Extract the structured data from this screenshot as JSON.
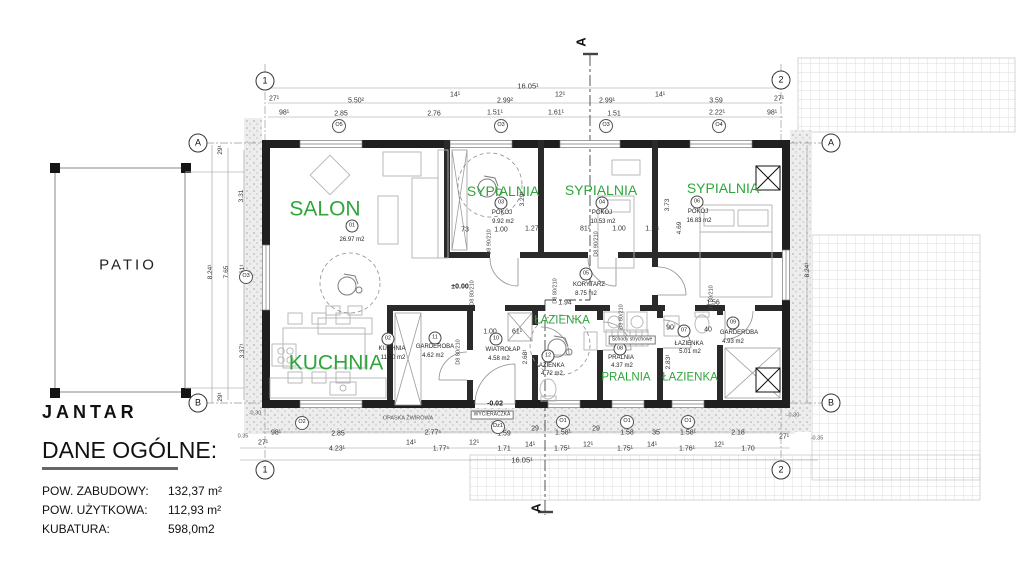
{
  "colors": {
    "room_label_green": "#2fa63b",
    "wall_color": "#1f1f1f",
    "annotation_color": "#333333"
  },
  "title_block": {
    "project_name": "JANTAR",
    "heading": "DANE OGÓLNE:",
    "stats": [
      {
        "label": "POW. ZABUDOWY:",
        "value": "132,37 m²"
      },
      {
        "label": "POW. UŻYTKOWA:",
        "value": "112,93 m²"
      },
      {
        "label": "KUBATURA:",
        "value": "598,0m2"
      }
    ]
  },
  "rooms": [
    {
      "number": "01",
      "name": "SALON",
      "area": "26.97 m2"
    },
    {
      "number": "02",
      "name": "KUCHNIA",
      "area": "11.60 m2"
    },
    {
      "number": "03",
      "name": "POKÓJ",
      "area": "9.92 m2"
    },
    {
      "number": "04",
      "name": "POKÓJ",
      "area": "10.53 m2"
    },
    {
      "number": "05",
      "name": "KORYTARZ",
      "area": "8.75 m2"
    },
    {
      "number": "06",
      "name": "POKÓJ",
      "area": "16.83 m2"
    },
    {
      "number": "07",
      "name": "ŁAZIENKA",
      "area": "5.01 m2"
    },
    {
      "number": "08",
      "name": "PRALNIA",
      "area": "4.37 m2"
    },
    {
      "number": "09",
      "name": "GARDEROBA",
      "area": "4.93 m2"
    },
    {
      "number": "10",
      "name": "WIATROŁAP",
      "area": "4.58 m2"
    },
    {
      "number": "11",
      "name": "GARDEROBA",
      "area": "4.62 m2"
    },
    {
      "number": "12",
      "name": "ŁAZIENKA",
      "area": "4.72 m2"
    }
  ],
  "annotations": [
    {
      "t": "SALON",
      "x": 325,
      "y": 209,
      "c": "green-lg"
    },
    {
      "t": "KUCHNIA",
      "x": 336,
      "y": 363,
      "c": "green-lg"
    },
    {
      "t": "SYPIALNIA",
      "x": 503,
      "y": 191,
      "c": "green-md"
    },
    {
      "t": "SYPIALNIA",
      "x": 601,
      "y": 190,
      "c": "green-md"
    },
    {
      "t": "SYPIALNIA",
      "x": 723,
      "y": 188,
      "c": "green-md"
    },
    {
      "t": "ŁAZIENKA",
      "x": 562,
      "y": 321,
      "c": "green-sm"
    },
    {
      "t": "PRALNIA",
      "x": 626,
      "y": 378,
      "c": "green-sm"
    },
    {
      "t": "ŁAZIENKA",
      "x": 690,
      "y": 378,
      "c": "green-sm"
    },
    {
      "t": "PATIO",
      "x": 128,
      "y": 265,
      "c": "patio"
    },
    {
      "t": "01",
      "x": 352,
      "y": 226,
      "c": "rnum"
    },
    {
      "t": "26.97 m2",
      "x": 352,
      "y": 240,
      "c": "rarea"
    },
    {
      "t": "02",
      "x": 388,
      "y": 339,
      "c": "rnum"
    },
    {
      "t": "KUCHNIA",
      "x": 392,
      "y": 349,
      "c": "rname"
    },
    {
      "t": "11.60 m2",
      "x": 393,
      "y": 358,
      "c": "rarea"
    },
    {
      "t": "03",
      "x": 501,
      "y": 203,
      "c": "rnum"
    },
    {
      "t": "POKÓJ",
      "x": 502,
      "y": 213,
      "c": "rname"
    },
    {
      "t": "9.92 m2",
      "x": 503,
      "y": 222,
      "c": "rarea"
    },
    {
      "t": "04",
      "x": 602,
      "y": 203,
      "c": "rnum"
    },
    {
      "t": "POKÓJ",
      "x": 602,
      "y": 213,
      "c": "rname"
    },
    {
      "t": "10.53 m2",
      "x": 603,
      "y": 222,
      "c": "rarea"
    },
    {
      "t": "06",
      "x": 697,
      "y": 202,
      "c": "rnum"
    },
    {
      "t": "POKÓJ",
      "x": 698,
      "y": 212,
      "c": "rname"
    },
    {
      "t": "16.83 m2",
      "x": 699,
      "y": 221,
      "c": "rarea"
    },
    {
      "t": "05",
      "x": 586,
      "y": 274,
      "c": "rnum"
    },
    {
      "t": "KORYTARZ",
      "x": 589,
      "y": 285,
      "c": "rname"
    },
    {
      "t": "8.75 m2",
      "x": 586,
      "y": 294,
      "c": "rarea"
    },
    {
      "t": "12",
      "x": 548,
      "y": 356,
      "c": "rnum"
    },
    {
      "t": "ŁAZIENKA",
      "x": 550,
      "y": 366,
      "c": "rname"
    },
    {
      "t": "4.72 m2",
      "x": 552,
      "y": 374,
      "c": "rarea"
    },
    {
      "t": "08",
      "x": 620,
      "y": 349,
      "c": "rnum"
    },
    {
      "t": "PRALNIA",
      "x": 621,
      "y": 358,
      "c": "rname"
    },
    {
      "t": "4.37 m2",
      "x": 622,
      "y": 366,
      "c": "rarea"
    },
    {
      "t": "07",
      "x": 684,
      "y": 331,
      "c": "rnum"
    },
    {
      "t": "ŁAZIENKA",
      "x": 689,
      "y": 344,
      "c": "rname"
    },
    {
      "t": "5.01 m2",
      "x": 690,
      "y": 352,
      "c": "rarea"
    },
    {
      "t": "09",
      "x": 733,
      "y": 323,
      "c": "rnum"
    },
    {
      "t": "GARDEROBA",
      "x": 739,
      "y": 333,
      "c": "rname"
    },
    {
      "t": "4.93 m2",
      "x": 733,
      "y": 342,
      "c": "rarea"
    },
    {
      "t": "10",
      "x": 496,
      "y": 339,
      "c": "rnum"
    },
    {
      "t": "WIATROŁAP",
      "x": 503,
      "y": 350,
      "c": "rname"
    },
    {
      "t": "4.58 m2",
      "x": 499,
      "y": 359,
      "c": "rarea"
    },
    {
      "t": "11",
      "x": 435,
      "y": 338,
      "c": "rnum"
    },
    {
      "t": "GARDEROBA",
      "x": 435,
      "y": 347,
      "c": "rname"
    },
    {
      "t": "4.62 m2",
      "x": 433,
      "y": 356,
      "c": "rarea"
    },
    {
      "t": "Schody strychowe",
      "x": 632,
      "y": 340,
      "c": "tinybox"
    },
    {
      "t": "WYCIERACZKA",
      "x": 492,
      "y": 415,
      "c": "tinybox"
    },
    {
      "t": "OPASKA ŻWIROWA",
      "x": 408,
      "y": 419,
      "c": "tiny"
    },
    {
      "t": "16.05¹",
      "x": 528,
      "y": 86,
      "c": "dimb"
    },
    {
      "t": "27¹",
      "x": 274,
      "y": 99,
      "c": "dim"
    },
    {
      "t": "5.50²",
      "x": 356,
      "y": 101,
      "c": "dim"
    },
    {
      "t": "14¹",
      "x": 455,
      "y": 95,
      "c": "dim"
    },
    {
      "t": "2.99²",
      "x": 505,
      "y": 101,
      "c": "dim"
    },
    {
      "t": "12¹",
      "x": 560,
      "y": 95,
      "c": "dim"
    },
    {
      "t": "2.99¹",
      "x": 607,
      "y": 101,
      "c": "dim"
    },
    {
      "t": "14¹",
      "x": 660,
      "y": 95,
      "c": "dim"
    },
    {
      "t": "3.59",
      "x": 716,
      "y": 101,
      "c": "dim"
    },
    {
      "t": "27¹",
      "x": 779,
      "y": 99,
      "c": "dim"
    },
    {
      "t": "98¹",
      "x": 284,
      "y": 113,
      "c": "dim"
    },
    {
      "t": "2.85",
      "x": 341,
      "y": 114,
      "c": "dim"
    },
    {
      "t": "2.76",
      "x": 434,
      "y": 114,
      "c": "dim"
    },
    {
      "t": "1.51¹",
      "x": 495,
      "y": 113,
      "c": "dim"
    },
    {
      "t": "1.61¹",
      "x": 556,
      "y": 113,
      "c": "dim"
    },
    {
      "t": "1.51",
      "x": 614,
      "y": 114,
      "c": "dim"
    },
    {
      "t": "2.22¹",
      "x": 717,
      "y": 113,
      "c": "dim"
    },
    {
      "t": "98¹",
      "x": 772,
      "y": 113,
      "c": "dim"
    },
    {
      "t": "O5",
      "x": 339,
      "y": 126,
      "c": "wtag"
    },
    {
      "t": "O3",
      "x": 501,
      "y": 126,
      "c": "wtag"
    },
    {
      "t": "O3",
      "x": 606,
      "y": 126,
      "c": "wtag"
    },
    {
      "t": "O4",
      "x": 719,
      "y": 126,
      "c": "wtag"
    },
    {
      "t": "-0.30",
      "x": 255,
      "y": 414,
      "c": "tiny"
    },
    {
      "t": "98¹",
      "x": 276,
      "y": 433,
      "c": "dim"
    },
    {
      "t": "2.85",
      "x": 338,
      "y": 434,
      "c": "dim"
    },
    {
      "t": "2.77⁵",
      "x": 433,
      "y": 433,
      "c": "dim"
    },
    {
      "t": "1.59",
      "x": 504,
      "y": 434,
      "c": "dim"
    },
    {
      "t": "29",
      "x": 535,
      "y": 429,
      "c": "dim"
    },
    {
      "t": "1.58¹",
      "x": 563,
      "y": 433,
      "c": "dim"
    },
    {
      "t": "29",
      "x": 596,
      "y": 429,
      "c": "dim"
    },
    {
      "t": "1.58",
      "x": 627,
      "y": 433,
      "c": "dim"
    },
    {
      "t": "35",
      "x": 656,
      "y": 433,
      "c": "dim"
    },
    {
      "t": "1.58¹",
      "x": 688,
      "y": 433,
      "c": "dim"
    },
    {
      "t": "2.18",
      "x": 738,
      "y": 433,
      "c": "dim"
    },
    {
      "t": "27¹",
      "x": 784,
      "y": 437,
      "c": "dim"
    },
    {
      "t": "-0.30",
      "x": 793,
      "y": 416,
      "c": "tiny"
    },
    {
      "t": "-0.35",
      "x": 817,
      "y": 439,
      "c": "tiny"
    },
    {
      "t": "0.35",
      "x": 243,
      "y": 437,
      "c": "tiny"
    },
    {
      "t": "27¹",
      "x": 263,
      "y": 443,
      "c": "dim"
    },
    {
      "t": "4.23¹",
      "x": 337,
      "y": 449,
      "c": "dim"
    },
    {
      "t": "14¹",
      "x": 411,
      "y": 443,
      "c": "dim"
    },
    {
      "t": "1.77⁵",
      "x": 441,
      "y": 449,
      "c": "dim"
    },
    {
      "t": "12¹",
      "x": 474,
      "y": 443,
      "c": "dim"
    },
    {
      "t": "1.71",
      "x": 504,
      "y": 449,
      "c": "dim"
    },
    {
      "t": "14¹",
      "x": 530,
      "y": 445,
      "c": "dim"
    },
    {
      "t": "1.75¹",
      "x": 562,
      "y": 449,
      "c": "dim"
    },
    {
      "t": "12¹",
      "x": 588,
      "y": 445,
      "c": "dim"
    },
    {
      "t": "1.75¹",
      "x": 625,
      "y": 449,
      "c": "dim"
    },
    {
      "t": "14¹",
      "x": 652,
      "y": 445,
      "c": "dim"
    },
    {
      "t": "1.76¹",
      "x": 687,
      "y": 449,
      "c": "dim"
    },
    {
      "t": "12¹",
      "x": 719,
      "y": 445,
      "c": "dim"
    },
    {
      "t": "1.70",
      "x": 748,
      "y": 449,
      "c": "dim"
    },
    {
      "t": "16.05¹",
      "x": 522,
      "y": 460,
      "c": "dimb"
    },
    {
      "t": "O2",
      "x": 302,
      "y": 423,
      "c": "wtag"
    },
    {
      "t": "Dz1",
      "x": 498,
      "y": 427,
      "c": "wtag"
    },
    {
      "t": "O1",
      "x": 563,
      "y": 422,
      "c": "wtag"
    },
    {
      "t": "O1",
      "x": 627,
      "y": 422,
      "c": "wtag"
    },
    {
      "t": "O1",
      "x": 688,
      "y": 422,
      "c": "wtag"
    },
    {
      "t": "3.31",
      "x": 242,
      "y": 196,
      "c": "vdim",
      "r": -90
    },
    {
      "t": "1.61¹",
      "x": 243,
      "y": 272,
      "c": "vdim",
      "r": -90
    },
    {
      "t": "3.37¹",
      "x": 243,
      "y": 351,
      "c": "vdim",
      "r": -90
    },
    {
      "t": "29¹",
      "x": 221,
      "y": 150,
      "c": "vdim",
      "r": -90
    },
    {
      "t": "29¹",
      "x": 221,
      "y": 397,
      "c": "vdim",
      "r": -90
    },
    {
      "t": "7.65",
      "x": 227,
      "y": 272,
      "c": "vdim",
      "r": -90
    },
    {
      "t": "8.24¹",
      "x": 211,
      "y": 272,
      "c": "vdim",
      "r": -90
    },
    {
      "t": "O3",
      "x": 246,
      "y": 277,
      "c": "wtag"
    },
    {
      "t": "8.24¹",
      "x": 808,
      "y": 270,
      "c": "vdim",
      "r": -90
    },
    {
      "t": "1",
      "x": 265,
      "y": 81,
      "c": "axis"
    },
    {
      "t": "2",
      "x": 781,
      "y": 80,
      "c": "axis"
    },
    {
      "t": "1",
      "x": 265,
      "y": 470,
      "c": "axis"
    },
    {
      "t": "2",
      "x": 781,
      "y": 470,
      "c": "axis"
    },
    {
      "t": "A",
      "x": 198,
      "y": 143,
      "c": "axis"
    },
    {
      "t": "A",
      "x": 831,
      "y": 143,
      "c": "axis"
    },
    {
      "t": "B",
      "x": 198,
      "y": 403,
      "c": "axis"
    },
    {
      "t": "B",
      "x": 831,
      "y": 403,
      "c": "axis"
    },
    {
      "t": "A",
      "x": 581,
      "y": 42,
      "c": "secA",
      "r": -90
    },
    {
      "t": "A",
      "x": 536,
      "y": 508,
      "c": "secA",
      "r": -90
    },
    {
      "t": "73",
      "x": 465,
      "y": 230,
      "c": "dim"
    },
    {
      "t": "1.00",
      "x": 501,
      "y": 230,
      "c": "dim"
    },
    {
      "t": "1.27¹",
      "x": 533,
      "y": 229,
      "c": "dim"
    },
    {
      "t": "81¹",
      "x": 585,
      "y": 229,
      "c": "dim"
    },
    {
      "t": "1.00",
      "x": 619,
      "y": 229,
      "c": "dim"
    },
    {
      "t": "1.18",
      "x": 652,
      "y": 229,
      "c": "dim"
    },
    {
      "t": "1.94",
      "x": 565,
      "y": 303,
      "c": "dim"
    },
    {
      "t": "1.56",
      "x": 713,
      "y": 303,
      "c": "dim"
    },
    {
      "t": "1.00",
      "x": 490,
      "y": 332,
      "c": "dim"
    },
    {
      "t": "61¹",
      "x": 517,
      "y": 332,
      "c": "dim"
    },
    {
      "t": "90",
      "x": 670,
      "y": 328,
      "c": "dim"
    },
    {
      "t": "40",
      "x": 708,
      "y": 330,
      "c": "dim"
    },
    {
      "t": "3.29¹",
      "x": 523,
      "y": 199,
      "c": "vdim",
      "r": -90
    },
    {
      "t": "3.73",
      "x": 668,
      "y": 205,
      "c": "vdim",
      "r": -90
    },
    {
      "t": "4.69",
      "x": 680,
      "y": 228,
      "c": "vdim",
      "r": -90
    },
    {
      "t": "2.68¹",
      "x": 526,
      "y": 357,
      "c": "vdim",
      "r": -90
    },
    {
      "t": "2.83¹",
      "x": 669,
      "y": 362,
      "c": "vdim",
      "r": -90
    },
    {
      "t": "D8 90/210",
      "x": 490,
      "y": 242,
      "c": "dtag",
      "r": -90
    },
    {
      "t": "D8 80/210",
      "x": 473,
      "y": 293,
      "c": "dtag",
      "r": -90
    },
    {
      "t": "D8 80/210",
      "x": 556,
      "y": 291,
      "c": "dtag",
      "r": -90
    },
    {
      "t": "D8 90/210",
      "x": 597,
      "y": 244,
      "c": "dtag",
      "r": -90
    },
    {
      "t": "D8 80/210",
      "x": 622,
      "y": 317,
      "c": "dtag",
      "r": -90
    },
    {
      "t": "D8 80/210",
      "x": 712,
      "y": 298,
      "c": "dtag",
      "r": -90
    },
    {
      "t": "D8 80/210",
      "x": 459,
      "y": 352,
      "c": "dtag",
      "r": -90
    },
    {
      "t": "±0.00",
      "x": 460,
      "y": 287,
      "c": "lvl"
    },
    {
      "t": "-0.02",
      "x": 495,
      "y": 404,
      "c": "lvl"
    }
  ]
}
